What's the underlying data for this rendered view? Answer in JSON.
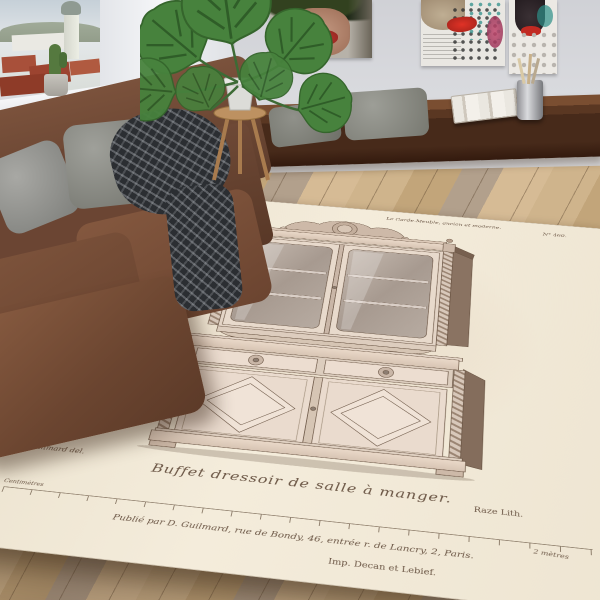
{
  "photo": {
    "description": "Living-room product photo of an area rug printed with an antique French furniture lithograph plate",
    "room": {
      "window_view": "city rooftops with dome tower and hills, cactus in gray pot on sill",
      "artworks": [
        "painted portrait close-up with red lips",
        "pop-art collage woman with red lips and dot pattern",
        "pop-art collage fragment with teal and pink dots"
      ],
      "plant": "monstera in white pot on wooden stool",
      "bench": "dark walnut console with two gray cushions, stack of papers, metal cup with pencils",
      "sofa": "brown fabric sofa with gray pillows and dark chunky-knit throw",
      "floor": "light oak plank floor"
    },
    "colors": {
      "paper": "#efe7d6",
      "ink": "#6b5645",
      "sofa": "#7a523c",
      "wall": "#d7d8db",
      "floor": "#c4a87e",
      "bench_wood": "#4a2e1f",
      "lips_red": "#c0392f"
    },
    "print": {
      "header_left": "Ameublement.",
      "header_center": "Le Garde-Meuble, ancien et moderne.",
      "plate_number": "N° 460.",
      "subject": "ornate carved buffet with glazed display top, twisted columns and diamond-panel doors",
      "artist_credit": "D. Guilmard del.",
      "title": "Buffet dressoir de salle à manger.",
      "lith_credit": "Raze Lith.",
      "scale_label_left": "Centimètres",
      "scale_label_right": "2 mètres",
      "publisher_line": "Publié par D. Guilmard, rue de Bondy, 46, entrée r. de Lancry, 2, Paris.",
      "printer_credit": "Imp. Decan et Lebief."
    }
  }
}
